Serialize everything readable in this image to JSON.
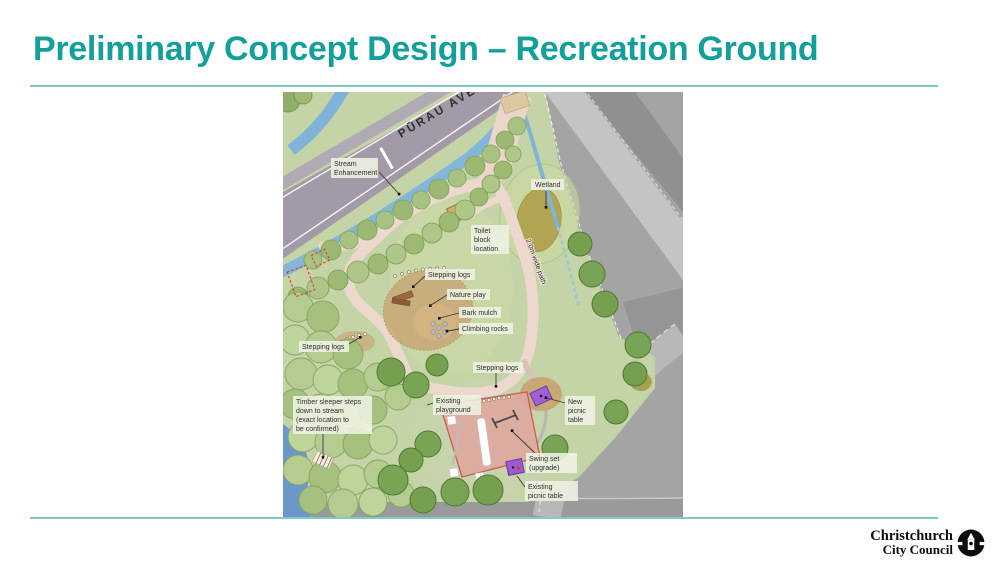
{
  "slide": {
    "title": "Preliminary Concept Design – Recreation Ground",
    "accent_color": "#13a09b",
    "rule_color": "#7ecac6"
  },
  "logo": {
    "line1": "Christchurch",
    "line2": "City Council",
    "icon": "cathedral-roundel-icon"
  },
  "map": {
    "road_name": "PŪRAU AVE",
    "palette": {
      "park_green": "#c5d4a6",
      "road_grey": "#a29aa7",
      "stream_blue": "#82b6da",
      "path_cream": "#ecd8cd",
      "playground_pink": "#dfa9a1",
      "picnic_purple": "#9c5bd4",
      "wetland_olive": "#b1a452",
      "aerial_grey": "#a4a4a4"
    },
    "labels": {
      "stream_enhancement": [
        "Stream",
        "Enhancement"
      ],
      "wetland": "Wetland",
      "toilet_block": [
        "Toilet",
        "block",
        "location"
      ],
      "path_width": "2.0m wide path",
      "stepping_logs_upper": "Stepping logs",
      "nature_play": "Nature play",
      "bark_mulch": "Bark mulch",
      "climbing_rocks": "Climbing rocks",
      "stepping_logs_left": "Stepping logs",
      "stepping_logs_lower": "Stepping logs",
      "timber_steps": [
        "Timber sleeper steps",
        "down to stream",
        "(exact location to",
        "be confirmed)"
      ],
      "existing_playground": [
        "Existing",
        "playground"
      ],
      "new_picnic_table": [
        "New",
        "picnic",
        "table"
      ],
      "swing_set": [
        "Swing set",
        "(upgrade)"
      ],
      "existing_picnic_table": [
        "Existing",
        "picnic table"
      ]
    }
  }
}
